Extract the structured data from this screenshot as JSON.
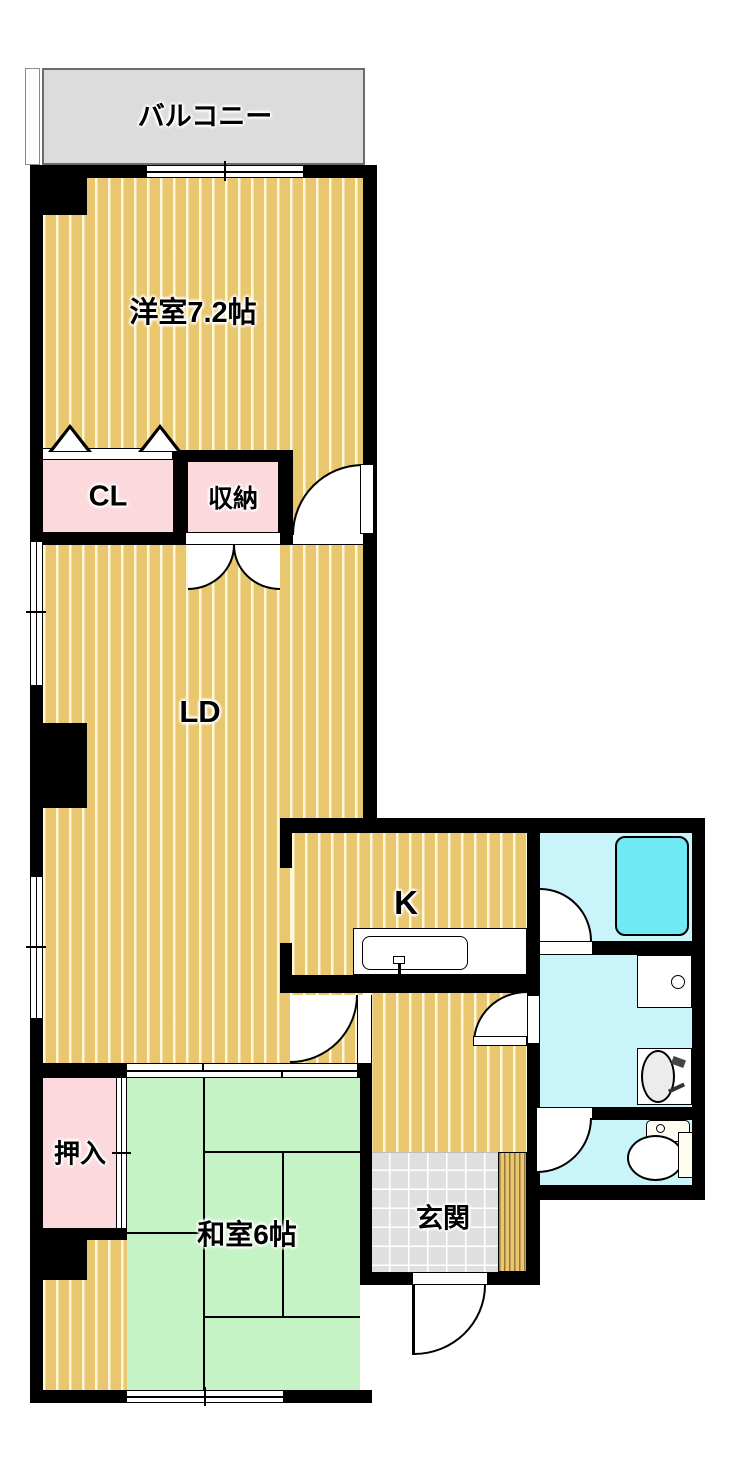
{
  "floorplan": {
    "rooms": {
      "balcony": {
        "label": "バルコニー"
      },
      "western_room": {
        "label": "洋室7.2帖"
      },
      "closet_cl": {
        "label": "CL"
      },
      "storage": {
        "label": "収納"
      },
      "living_dining": {
        "label": "LD"
      },
      "kitchen": {
        "label": "K"
      },
      "oshiire": {
        "label": "押入"
      },
      "japanese_room": {
        "label": "和室6帖"
      },
      "entrance": {
        "label": "玄関"
      }
    },
    "fixtures": [
      "kitchen-sink",
      "bathtub",
      "washing-machine-pan",
      "washbasin",
      "toilet"
    ],
    "colors": {
      "wall": "#000000",
      "wood_floor": "#e9c76f",
      "wood_stripe": "#fffade",
      "tatami": "#c6f3c6",
      "closet_pink": "#fcd9dd",
      "wet_floor": "#c9f4f9",
      "bathtub": "#6fe9f4",
      "entrance_tile": "#dfdfdf",
      "balcony_gray": "#dcdcdc"
    }
  }
}
